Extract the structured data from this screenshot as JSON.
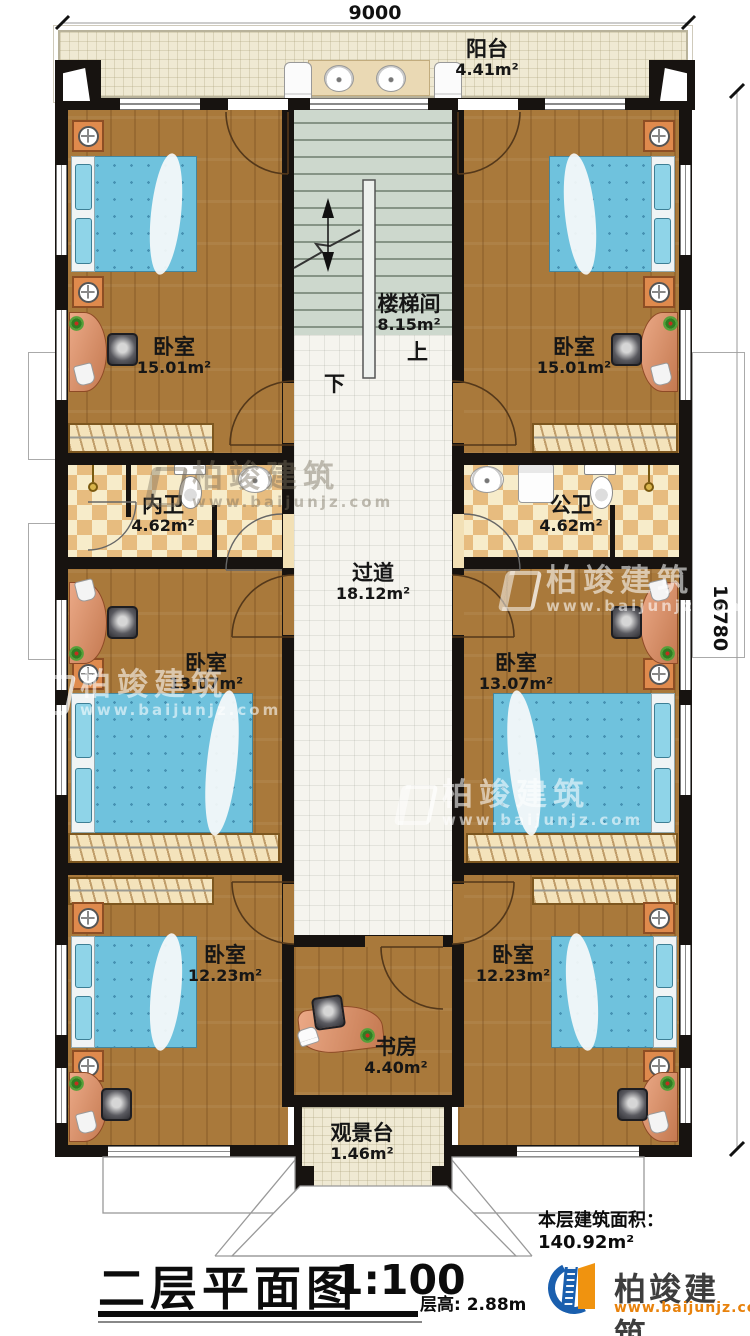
{
  "dimensions": {
    "top_width": "9000",
    "right_height": "16780"
  },
  "rooms": [
    {
      "id": "balcony",
      "name": "阳台",
      "area": "4.41m²"
    },
    {
      "id": "stairwell",
      "name": "楼梯间",
      "area": "8.15m²",
      "up": "上",
      "down": "下"
    },
    {
      "id": "bedroom-top-left",
      "name": "卧室",
      "area": "15.01m²"
    },
    {
      "id": "bedroom-top-right",
      "name": "卧室",
      "area": "15.01m²"
    },
    {
      "id": "bath-inner",
      "name": "内卫",
      "area": "4.62m²"
    },
    {
      "id": "bath-public",
      "name": "公卫",
      "area": "4.62m²"
    },
    {
      "id": "corridor",
      "name": "过道",
      "area": "18.12m²"
    },
    {
      "id": "bedroom-mid-left",
      "name": "卧室",
      "area": "13.07m²"
    },
    {
      "id": "bedroom-mid-right",
      "name": "卧室",
      "area": "13.07m²"
    },
    {
      "id": "bedroom-bottom-left",
      "name": "卧室",
      "area": "12.23m²"
    },
    {
      "id": "bedroom-bottom-right",
      "name": "卧室",
      "area": "12.23m²"
    },
    {
      "id": "study",
      "name": "书房",
      "area": "4.40m²"
    },
    {
      "id": "view-deck",
      "name": "观景台",
      "area": "1.46m²"
    }
  ],
  "annotations": {
    "floor_area": "本层建筑面积：140.92m²"
  },
  "title_block": {
    "title": "二层平面图",
    "scale": "1:100",
    "floor_height": "层高: 2.88m"
  },
  "brand": {
    "name": "柏竣建筑",
    "website": "www.baijunjz.com"
  },
  "colors": {
    "wall": "#171310",
    "wood": "#a9793b",
    "bed": "#6fc2dd",
    "brand_blue": "#1a5fae",
    "brand_orange": "#e8820c"
  }
}
